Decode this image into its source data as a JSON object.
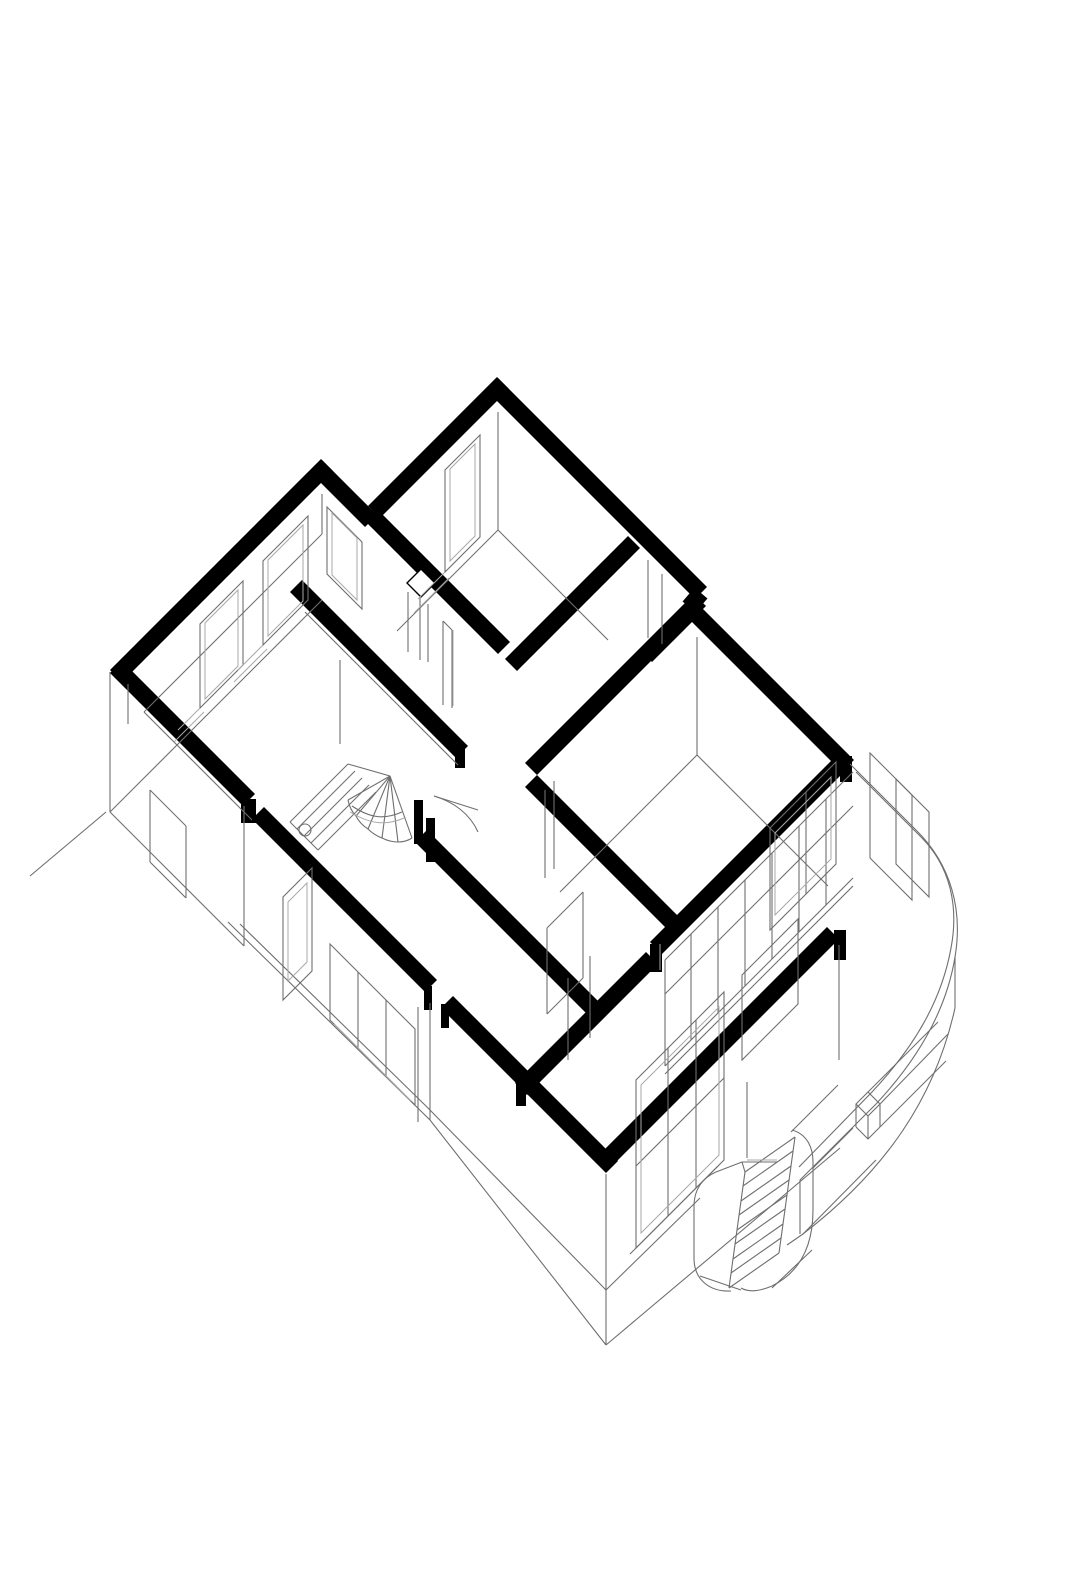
{
  "meta": {
    "description": "Axonometric cutaway drawing of a house upper-floor plan (45-degree plan oblique), black poche cut walls, thin gray linework for lower storey, interior winder stair, curved terrace parapet and exterior stair",
    "background_color": "#ffffff",
    "ink_color": "#000000",
    "thin_line_color": "#6f6f6f",
    "light_line_color": "#a9a9a9",
    "cut_wall_stroke_width": 17
  },
  "layers": [
    {
      "name": "cut-walls",
      "class": "cut",
      "paths": [
        "M503,383 L374,512",
        "M316,466 L371,521",
        "M327,465 L116,676",
        "M116,667 L249,800",
        "M258,813 L431,986",
        "M447,1002 L612,1167",
        "M600,1166 L833,933",
        "M492,384 L701,593",
        "M701,593 L689,607",
        "M689,607 L848,766",
        "M700,600 L531,769",
        "M296,586 L462,752",
        "M531,781 L682,932",
        "M369,513 L504,648",
        "M846,758 L656,948",
        "M652,958 L521,1089",
        "M634,542 L511,665",
        "M697,605 L646,656",
        "M421,836 L597,1012"
      ]
    },
    {
      "name": "wall-end-faces",
      "class": "endface",
      "paths": [
        "M241,799 h15 v24 h-15 Z",
        "M414,800 h9 v44 h-9 Z",
        "M426,818 h9 v44 h-9 Z",
        "M650,944 h12 v28 h-12 Z",
        "M834,930 h12 v30 h-12 Z",
        "M840,756 h12 v26 h-12 Z",
        "M455,744 h10 v24 h-10 Z",
        "M424,986 h8 v24 h-8 Z",
        "M441,1004 h8 v24 h-8 Z",
        "M516,1084 h10 v22 h-10 Z"
      ]
    },
    {
      "name": "duct-shaft",
      "class": "shaft",
      "paths": [
        "M421,569 L435,583 L421,597 L407,583 Z"
      ]
    },
    {
      "name": "interior-lines",
      "class": "thin",
      "paths": [
        "M498,412 L498,530",
        "M498,530 L608,640",
        "M498,530 L397,631",
        "M480,435 L445,470 L445,572 L480,537 Z",
        "M322,494 L322,534",
        "M322,534 L144,712",
        "M144,712 L252,820",
        "M128,684 L128,724",
        "M308,516 L263,561 L263,645 L308,600 Z",
        "M243,581 L200,624 L200,708 L243,665 Z",
        "M327,507 L362,542 L362,609 L327,574 Z",
        "M443,621 L443,705",
        "M452,630 L452,708",
        "M443,621 L452,630",
        "M408,592 L408,652",
        "M420,598 L420,660",
        "M428,604 L428,662",
        "M340,660 L340,744",
        "M305,612 L458,765",
        "M434,796 C454,802 470,814 478,832",
        "M434,796 L478,810",
        "M697,637 L697,755",
        "M697,755 L828,886",
        "M697,755 L560,892",
        "M545,790 L545,878",
        "M554,781 L554,869",
        "M648,560 L648,638",
        "M662,574 L662,644",
        "M547,928 L547,1014",
        "M583,892 L583,978",
        "M547,928 L583,892",
        "M547,1014 L583,978",
        "M568,978 L568,1060",
        "M590,956 L590,1038"
      ]
    },
    {
      "name": "facade-lines",
      "class": "thin",
      "paths": [
        "M110,672 L110,812",
        "M110,812 L244,946",
        "M110,812 L322,600",
        "M244,806 L244,946",
        "M150,790 L186,826",
        "M150,790 L150,862",
        "M186,826 L186,898",
        "M150,862 L186,898",
        "M283,897 L312,868 L312,971 L283,1000 Z",
        "M330,944 L415,1029 L415,1105 L330,1020 Z",
        "M358,972 L358,1048",
        "M386,1000 L386,1076",
        "M418,1007 L418,1122",
        "M430,1003 L430,1120",
        "M606,1174 L606,1345",
        "M228,922 L430,1120 L606,1345",
        "M240,924 L428,1108 L606,1290",
        "M106,812 L30,876",
        "M606,1345 L840,1148",
        "M606,1290 L700,1198",
        "M636,1080 L724,992 L724,1160 L636,1248 Z",
        "M636,1166 L724,1078",
        "M668,1048 L668,1216",
        "M696,1020 L696,1188",
        "M630,1254 L718,1166",
        "M742,975 L798,919 L798,1004 L742,1060 Z",
        "M839,945 L839,1060",
        "M770,828 L836,762 L836,864 L770,930 Z",
        "M806,792 L806,894",
        "M747,1082 L747,1158"
      ]
    },
    {
      "name": "terrace-glazing",
      "class": "thin",
      "paths": [
        "M853,772 L665,960",
        "M853,806 L665,994",
        "M853,878 L665,1066",
        "M853,886 L665,1074",
        "M665,960 L665,1066",
        "M826,799 L826,905",
        "M799,826 L799,932",
        "M772,853 L772,959",
        "M745,880 L745,986",
        "M718,907 L718,1013",
        "M691,934 L691,1040"
      ]
    },
    {
      "name": "terrace-parapet",
      "class": "thin",
      "paths": [
        "M850,764 L917,831",
        "M856,772 L921,837",
        "M917,831 C951,865 963,910 955,957 C947,1006 921,1056 876,1104 L800,1180",
        "M921,837 C950,866 959,906 951,948 C942,998 917,1044 872,1092 L799,1167",
        "M955,1008 C935,1098 886,1170 803,1234 L787,1245",
        "M955,957 L955,1008",
        "M800,1180 L800,1234",
        "M803,1234 L876,1160",
        "M856,1104 L868,1092 L880,1104 L868,1116 Z",
        "M856,1104 L856,1127",
        "M868,1116 L868,1139",
        "M880,1104 L880,1127",
        "M856,1127 L868,1139 L880,1127",
        "M868,1092 L938,1022",
        "M880,1104 L948,1034",
        "M880,1127 L946,1061",
        "M870,753 L912,795 L912,900 L870,858 Z",
        "M896,779 L929,812 L929,897 L896,864 Z"
      ]
    },
    {
      "name": "exterior-stair",
      "class": "thin",
      "paths": [
        "M745,1172 L795,1137",
        "M743,1186 L793,1151",
        "M741,1201 L791,1166",
        "M739,1215 L789,1180",
        "M737,1230 L787,1195",
        "M735,1244 L785,1209",
        "M733,1259 L783,1224",
        "M731,1273 L781,1238",
        "M729,1288 L779,1253",
        "M745,1172 L729,1288",
        "M795,1137 L779,1253",
        "M742,1162 L777,1162",
        "M742,1162 L745,1172",
        "M694,1206 L694,1258",
        "M694,1206 C694,1190 702,1178 716,1172",
        "M694,1258 C694,1280 710,1292 731,1291",
        "M716,1172 L742,1162",
        "M792,1130 C806,1134 813,1146 813,1162",
        "M813,1162 L813,1210",
        "M813,1210 C813,1246 800,1272 772,1286",
        "M772,1286 C758,1292 748,1292 741,1288",
        "M813,1168 L853,1128",
        "M791,1132 L838,1085",
        "M700,1276 L741,1290",
        "M772,1288 L812,1250"
      ]
    },
    {
      "name": "winder-stair",
      "class": "thin",
      "paths": [
        "M290,822 L348,764",
        "M297,829 L355,771",
        "M304,836 L362,778",
        "M311,843 L369,785",
        "M318,850 L376,792",
        "M290,822 L318,850",
        "M348,764 L390,776",
        "M390,776 L348,800",
        "M390,776 L356,816",
        "M390,776 L368,829",
        "M390,776 L382,838",
        "M390,776 L398,842",
        "M390,776 L412,838",
        "M348,800 Q350,810 356,816 Q360,824 368,829 Q374,835 382,838 Q390,842 398,842 Q406,842 412,838",
        "M352,806 C370,818 384,820 402,812",
        "M311,830 A6,6 0 1 1 299,830 A6,6 0 1 1 311,830"
      ]
    },
    {
      "name": "inner-frames-sills",
      "class": "light",
      "paths": [
        "M475,444 L450,469 L450,561 L475,536 Z",
        "M445,572 L418,599",
        "M449,578 L414,613",
        "M303,525 L268,560 L268,636 L303,601 Z",
        "M263,645 L238,670",
        "M267,649 L234,682",
        "M238,590 L205,623 L205,699 L238,666 Z",
        "M200,708 L178,730",
        "M204,712 L174,742",
        "M332,513 L357,538 L357,600 L332,575 Z",
        "M288,902 L307,883 L307,962 L288,981 Z",
        "M334,1024 L411,1101",
        "M641,1085 L719,1007 L719,1155 L641,1233 Z",
        "M775,833 L831,777 L831,859 L775,915 Z",
        "M350,812 C370,824 386,826 404,818",
        "M453,630 L453,706",
        "M660,944 L660,970",
        "M747,1160 L777,1160"
      ]
    }
  ]
}
